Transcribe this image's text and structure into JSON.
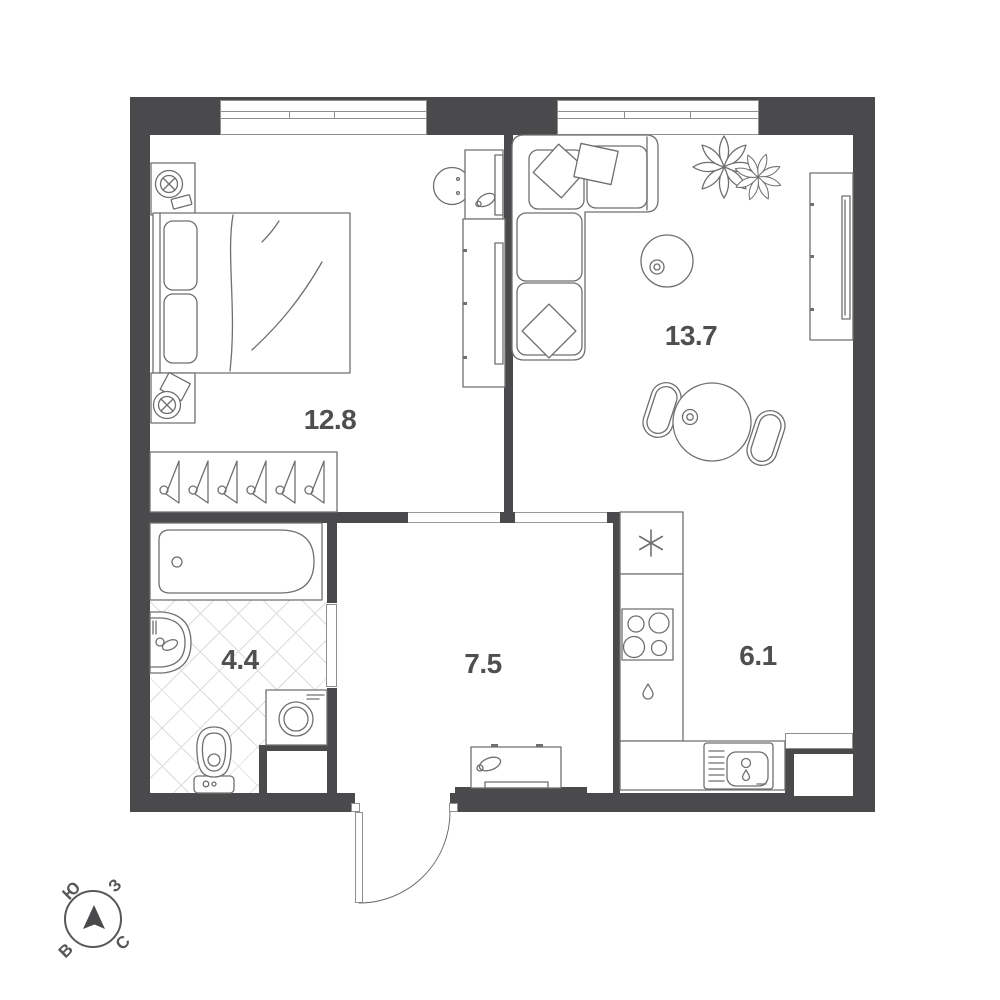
{
  "plan": {
    "rooms": [
      {
        "name": "bedroom",
        "area": "12.8"
      },
      {
        "name": "living-room",
        "area": "13.7"
      },
      {
        "name": "bathroom",
        "area": "4.4"
      },
      {
        "name": "hallway",
        "area": "7.5"
      },
      {
        "name": "kitchen",
        "area": "6.1"
      }
    ],
    "compass": {
      "south": "Ю",
      "west": "З",
      "north": "С",
      "east": "В"
    },
    "icons": [
      "bed",
      "pillow",
      "table-lamp",
      "hanger",
      "wardrobe",
      "desk",
      "desk-chair",
      "corner-sofa",
      "plant",
      "pouf",
      "tv-console",
      "dining-table",
      "chair",
      "fridge-snowflake",
      "stove-burners",
      "dishwasher-drop",
      "kitchen-sink",
      "bathtub",
      "washbasin",
      "toilet",
      "washing-machine",
      "shoe-cabinet",
      "entrance-door-arc",
      "north-arrow"
    ],
    "colors": {
      "wall": "#4a4a4c",
      "furniture_line": "#6f6f6f",
      "hatch": "#dcdcdc",
      "label": "#4f4f4f",
      "background": "#ffffff"
    }
  }
}
